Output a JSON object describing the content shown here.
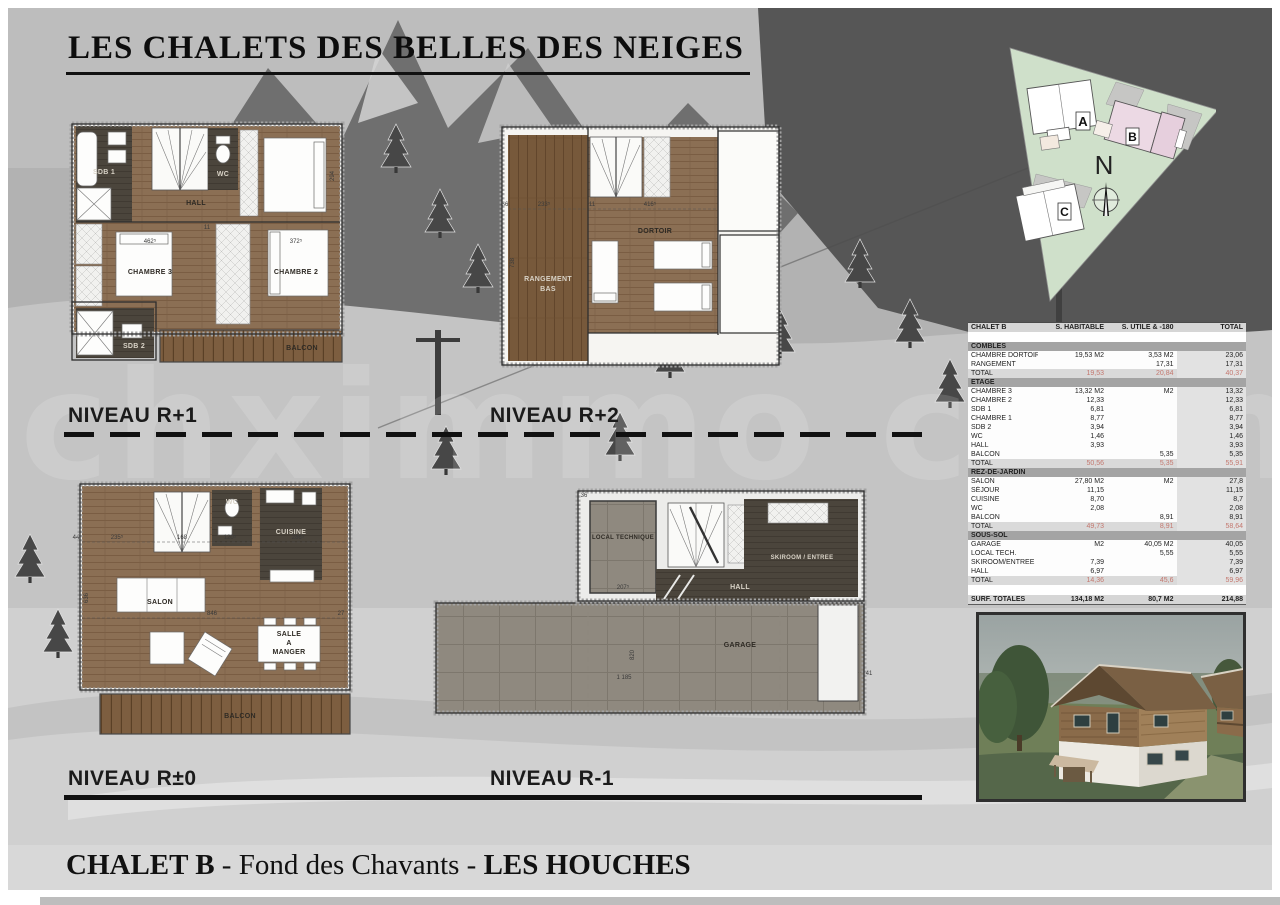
{
  "page": {
    "title": "LES CHALETS DES BELLES DES NEIGES",
    "watermark": "chximmo chamonix"
  },
  "levels": {
    "r1": "NIVEAU R+1",
    "r2": "NIVEAU R+2",
    "r0": "NIVEAU R±0",
    "rm1": "NIVEAU R-1"
  },
  "site_plan": {
    "building_a": "A",
    "building_b": "B",
    "building_c": "C",
    "north": "N"
  },
  "plans": {
    "r1": {
      "sdb1": "SDB 1",
      "wc": "WC",
      "hall": "HALL",
      "ch3": "CHAMBRE 3",
      "ch2": "CHAMBRE 2",
      "sdb2": "SDB 2",
      "balcon": "BALCON",
      "d_ch3": "462⁵",
      "d_ch2": "372⁵",
      "d_right": "294",
      "d_mid": "11"
    },
    "r2": {
      "rangement1": "RANGEMENT",
      "rangement2": "BAS",
      "dortoir": "DORTOIR",
      "d_left": "233⁵",
      "d_mid": "416⁵",
      "d_side": "738",
      "d_11": "11",
      "d_36": "36"
    },
    "r0": {
      "wc": "WC",
      "cuisine": "CUISINE",
      "salon": "SALON",
      "salle1": "SALLE",
      "salle2": "A",
      "salle3": "MANGER",
      "balcon": "BALCON",
      "d1": "235⁵",
      "d2": "168",
      "d3": "120⁵",
      "d4": "286⁵",
      "d5": "846",
      "d6": "636",
      "d7": "44",
      "d8": "27"
    },
    "rm1": {
      "local": "LOCAL TECHNIQUE",
      "hall": "HALL",
      "skiroom": "SKIROOM / ENTREE",
      "garage": "GARAGE",
      "d1": "207⁵",
      "d2": "1 185",
      "d3": "820",
      "d4": "41",
      "d5": "36"
    }
  },
  "surface_table": {
    "columns": [
      "CHALET B",
      "S. HABITABLE",
      "S. UTILE & -180",
      "TOTAL"
    ],
    "sections": [
      {
        "name": "COMBLES",
        "rows": [
          [
            "CHAMBRE DORTOIR",
            "19,53 M2",
            "3,53 M2",
            "23,06"
          ],
          [
            "RANGEMENT",
            "",
            "17,31",
            "17,31"
          ]
        ],
        "total": [
          "TOTAL",
          "19,53",
          "20,84",
          "40,37"
        ]
      },
      {
        "name": "ETAGE",
        "rows": [
          [
            "CHAMBRE 3",
            "13,32 M2",
            "M2",
            "13,32"
          ],
          [
            "CHAMBRE 2",
            "12,33",
            "",
            "12,33"
          ],
          [
            "SDB 1",
            "6,81",
            "",
            "6,81"
          ],
          [
            "CHAMBRE 1",
            "8,77",
            "",
            "8,77"
          ],
          [
            "SDB 2",
            "3,94",
            "",
            "3,94"
          ],
          [
            "WC",
            "1,46",
            "",
            "1,46"
          ],
          [
            "HALL",
            "3,93",
            "",
            "3,93"
          ],
          [
            "BALCON",
            "",
            "5,35",
            "5,35"
          ]
        ],
        "total": [
          "TOTAL",
          "50,56",
          "5,35",
          "55,91"
        ]
      },
      {
        "name": "REZ-DE-JARDIN",
        "rows": [
          [
            "SALON",
            "27,80 M2",
            "M2",
            "27,8"
          ],
          [
            "SÉJOUR",
            "11,15",
            "",
            "11,15"
          ],
          [
            "CUISINE",
            "8,70",
            "",
            "8,7"
          ],
          [
            "WC",
            "2,08",
            "",
            "2,08"
          ],
          [
            "BALCON",
            "",
            "8,91",
            "8,91"
          ]
        ],
        "total": [
          "TOTAL",
          "49,73",
          "8,91",
          "58,64"
        ]
      },
      {
        "name": "SOUS-SOL",
        "rows": [
          [
            "GARAGE",
            "M2",
            "40,05 M2",
            "40,05"
          ],
          [
            "LOCAL TECH.",
            "",
            "5,55",
            "5,55"
          ],
          [
            "SKIROOM/ENTREE",
            "7,39",
            "",
            "7,39"
          ],
          [
            "HALL",
            "6,97",
            "",
            "6,97"
          ]
        ],
        "total": [
          "TOTAL",
          "14,36",
          "45,6",
          "59,96"
        ]
      }
    ],
    "grand_total": [
      "SURF. TOTALES",
      "134,18  M2",
      "80,7  M2",
      "214,88"
    ]
  },
  "footer": {
    "bold1": "CHALET B",
    "middle": " - Fond des Chavants - ",
    "bold2": "LES HOUCHES"
  }
}
